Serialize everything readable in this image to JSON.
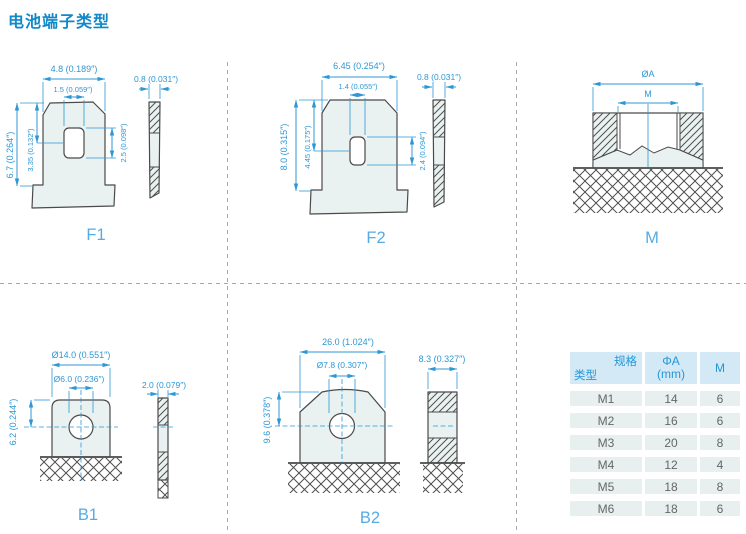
{
  "page": {
    "title": "电池端子类型"
  },
  "diagrams": {
    "f1": {
      "label": "F1",
      "dims": {
        "top_width": "4.8 (0.189″)",
        "slot_width": "1.5 (0.059″)",
        "thickness": "0.8 (0.031″)",
        "height": "6.7 (0.264″)",
        "slot_center": "3.35 (0.132″)",
        "slot_height": "2.5 (0.098″)"
      }
    },
    "f2": {
      "label": "F2",
      "dims": {
        "top_width": "6.45 (0.254″)",
        "slot_width": "1.4 (0.055″)",
        "thickness": "0.8 (0.031″)",
        "height": "8.0 (0.315″)",
        "slot_center": "4.45 (0.175″)",
        "slot_height": "2.4 (0.094″)"
      }
    },
    "m": {
      "label": "M",
      "dims": {
        "outer_dia": "ØA",
        "thread": "M"
      }
    },
    "b1": {
      "label": "B1",
      "dims": {
        "width": "Ø14.0 (0.551″)",
        "hole": "Ø6.0 (0.236″)",
        "height": "6.2 (0.244″)",
        "thickness": "2.0 (0.079″)"
      }
    },
    "b2": {
      "label": "B2",
      "dims": {
        "width": "26.0 (1.024″)",
        "hole": "Ø7.8 (0.307″)",
        "height": "9.6 (0.378″)",
        "thickness": "8.3 (0.327″)"
      }
    }
  },
  "spec_table": {
    "header": {
      "corner_top": "规格",
      "corner_bottom": "类型",
      "col2_line1": "ΦA",
      "col2_line2": "(mm)",
      "col3": "M"
    },
    "rows": [
      {
        "type": "M1",
        "phi_a": "14",
        "m": "6"
      },
      {
        "type": "M2",
        "phi_a": "16",
        "m": "6"
      },
      {
        "type": "M3",
        "phi_a": "20",
        "m": "8"
      },
      {
        "type": "M4",
        "phi_a": "12",
        "m": "4"
      },
      {
        "type": "M5",
        "phi_a": "18",
        "m": "8"
      },
      {
        "type": "M6",
        "phi_a": "18",
        "m": "6"
      }
    ]
  },
  "colors": {
    "accent_blue": "#2e97d5",
    "title_blue": "#0f89c9",
    "label_blue": "#55abe3",
    "line_gray": "#4a4a4a",
    "fill_mint": "#e9f2f0",
    "table_header_bg": "#d3e9f6",
    "table_row_bg": "#e7f0ef"
  }
}
